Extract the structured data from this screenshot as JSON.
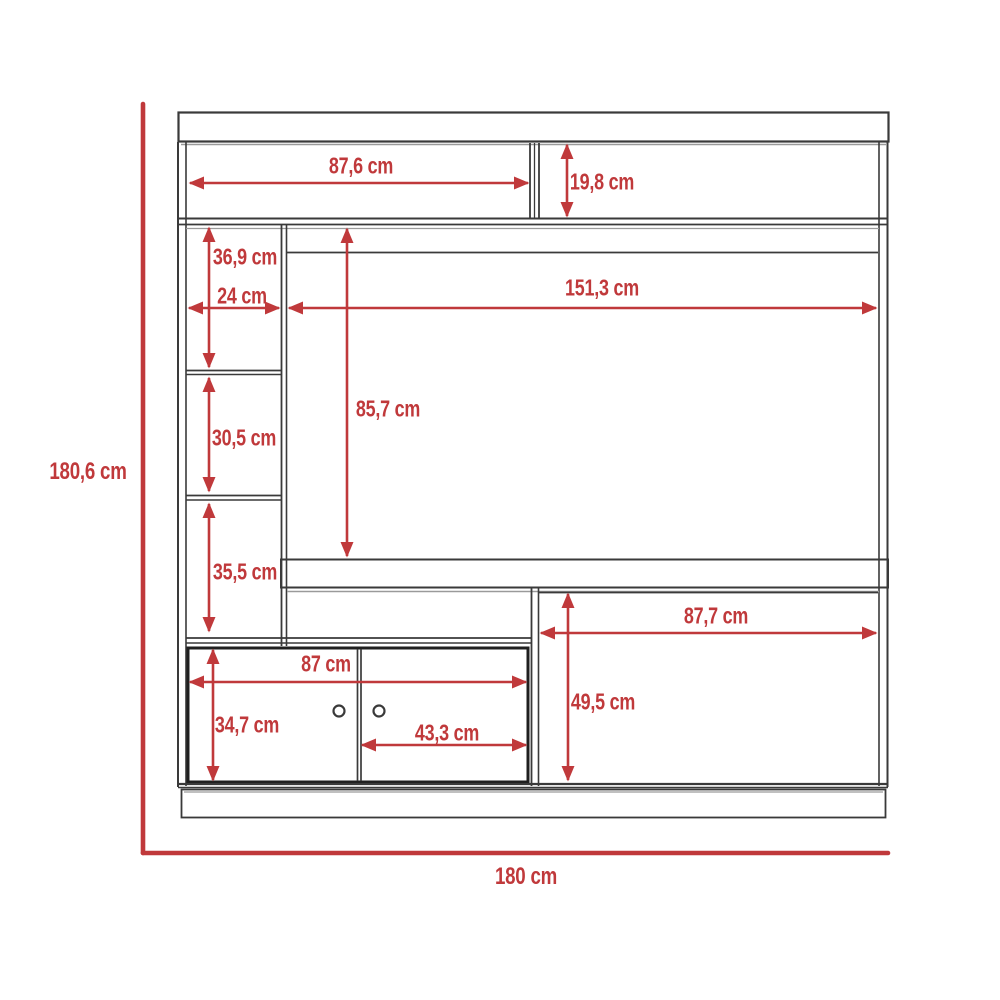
{
  "page": {
    "type": "furniture dimensional drawing",
    "background": "#ffffff"
  },
  "colors": {
    "dimension_red": "#c0393b",
    "outline_dark": "#3a3a3a",
    "outline_light": "#9a9a9a",
    "door_outline": "#1f1f1f"
  },
  "unit": "cm",
  "overall_dimensions": {
    "height": "180,6 cm",
    "width": "180 cm"
  },
  "part_dimensions": {
    "top_left_shelf_width": "87,6 cm",
    "top_right_shelf_height": "19,8 cm",
    "left_column_top_compartment_height": "36,9 cm",
    "left_column_width": "24 cm",
    "tv_opening_width": "151,3 cm",
    "tv_opening_height": "85,7 cm",
    "left_column_middle_compartment_height": "30,5 cm",
    "left_column_bottom_compartment_height": "35,5 cm",
    "bottom_right_opening_width": "87,7 cm",
    "door_cabinet_width": "87 cm",
    "bottom_right_opening_height": "49,5 cm",
    "door_cabinet_height": "34,7 cm",
    "single_door_width": "43,3 cm"
  }
}
